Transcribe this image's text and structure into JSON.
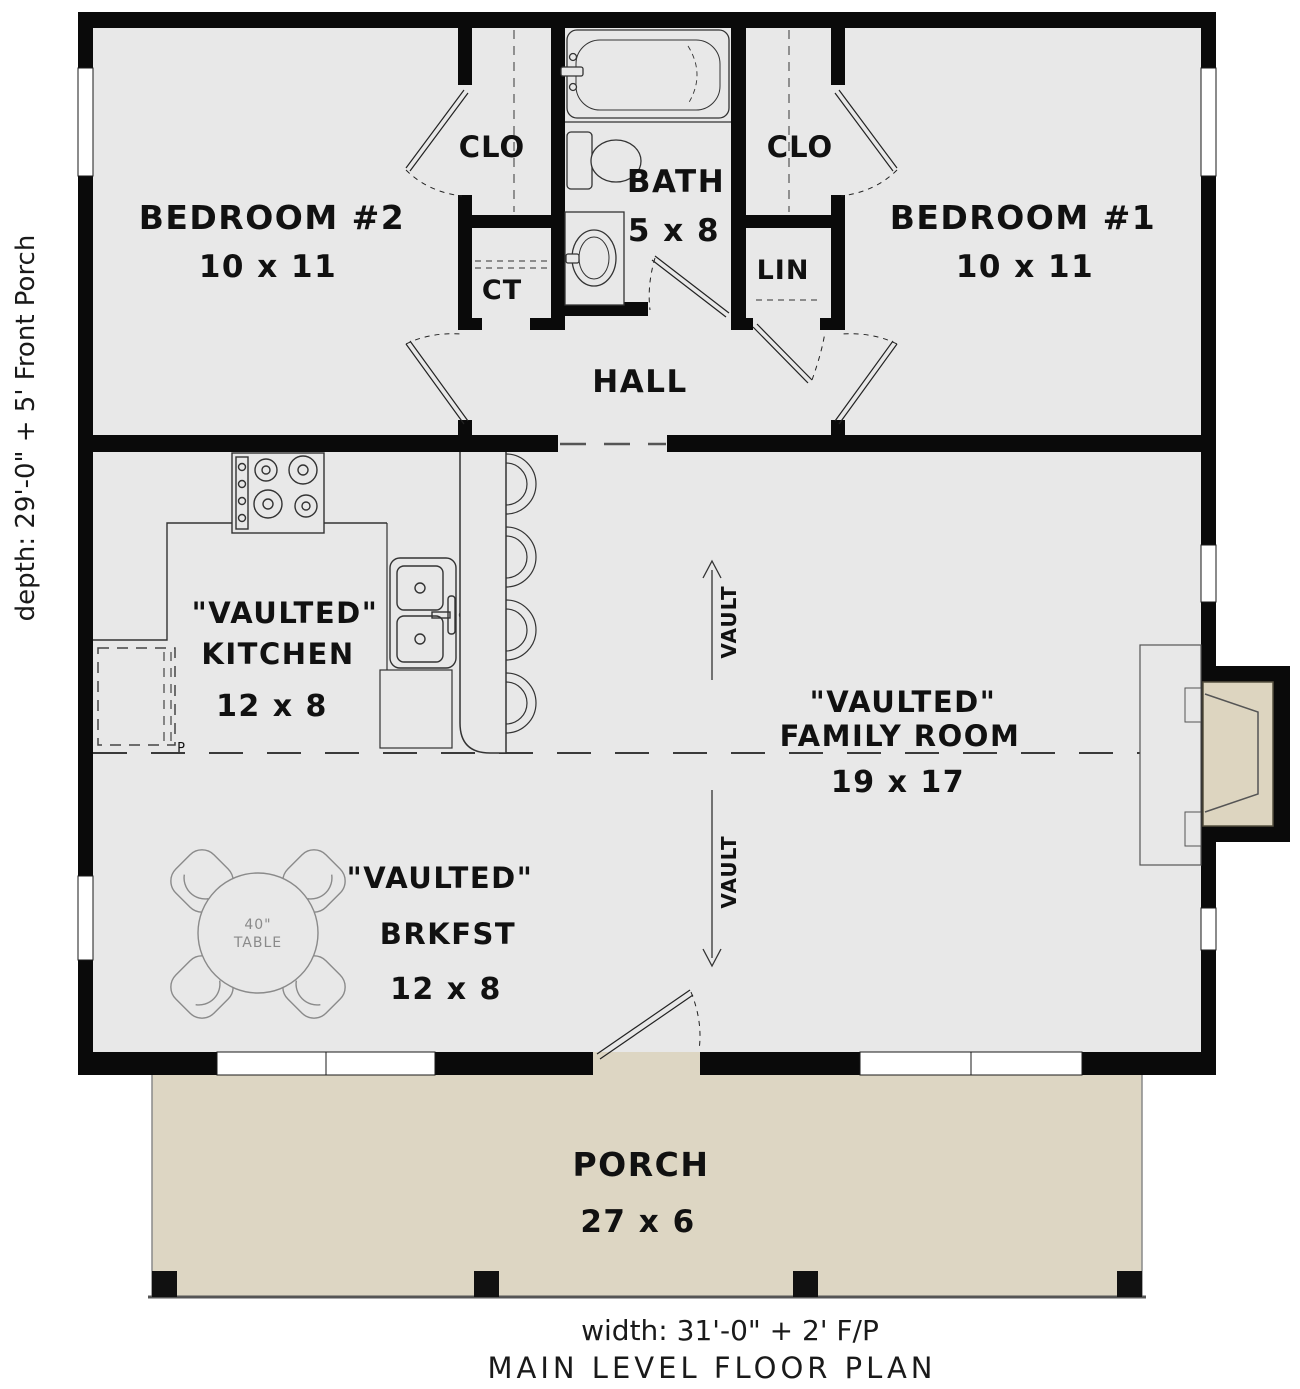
{
  "plan": {
    "rooms": {
      "bedroom2": {
        "name": "BEDROOM #2",
        "dims": "10 x 11"
      },
      "bedroom1": {
        "name": "BEDROOM #1",
        "dims": "10 x 11"
      },
      "bath": {
        "name": "BATH",
        "dims": "5 x 8"
      },
      "kitchen": {
        "prefix": "\"VAULTED\"",
        "name": "KITCHEN",
        "dims": "12 x 8"
      },
      "family_room": {
        "prefix": "\"VAULTED\"",
        "name": "FAMILY ROOM",
        "dims": "19 x 17"
      },
      "breakfast": {
        "prefix": "\"VAULTED\"",
        "name": "BRKFST",
        "dims": "12 x 8"
      },
      "porch": {
        "name": "PORCH",
        "dims": "27 x 6"
      },
      "hall": {
        "name": "HALL"
      },
      "closet_left": {
        "name": "CLO"
      },
      "closet_right": {
        "name": "CLO"
      },
      "coat_closet": {
        "name": "CT"
      },
      "linen": {
        "name": "LIN"
      }
    },
    "fixtures": {
      "table": {
        "line1": "40\"",
        "line2": "TABLE"
      },
      "pantry": {
        "label": "P"
      }
    },
    "vault_label": "VAULT",
    "annotations": {
      "depth": "depth: 29'-0\" + 5' Front Porch",
      "width": "width: 31'-0\" + 2' F/P",
      "title": "MAIN LEVEL FLOOR PLAN"
    },
    "colors": {
      "wall": "#0a0a0a",
      "floor": "#e8e8e8",
      "porch": "#ddd6c3",
      "fireplace": "#ddd5c0",
      "line": "#333333"
    }
  }
}
